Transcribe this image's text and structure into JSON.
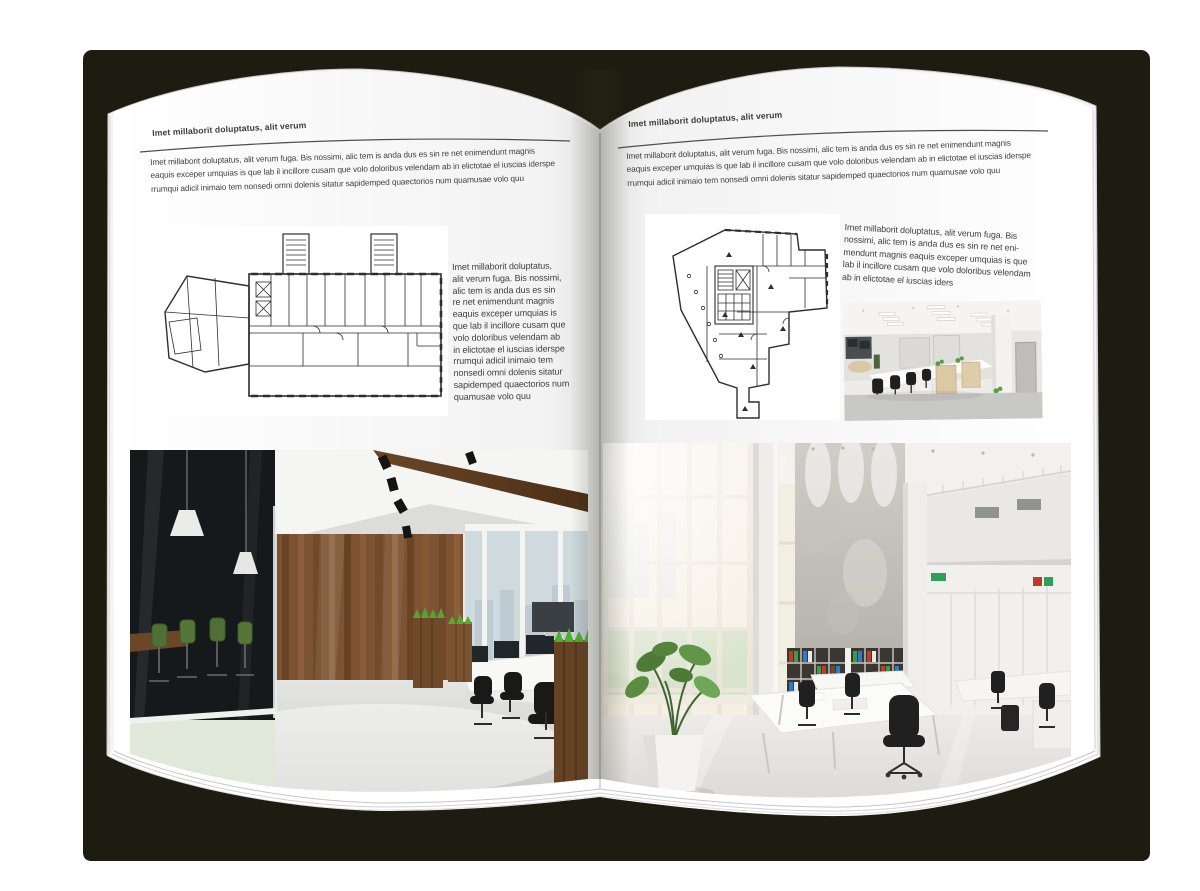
{
  "left_page": {
    "header": "Imet millaborit doluptatus, alit verum",
    "intro_lines": [
      "Imet millaborit doluptatus, alit verum fuga. Bis nossimi, alic tem is anda dus es sin re net enimendunt magnis",
      "eaquis exceper umquias is que lab il incillore cusam que volo doloribus velendam ab in elictotae el iuscias iderspe",
      "rrumqui adicil inimaio tem nonsedi omni dolenis sitatur sapidemped quaectorios num quamusae volo quu"
    ],
    "sidebar_lines": [
      "Imet millaborit doluptatus,",
      "alit verum fuga. Bis nossimi,",
      "alic tem is anda dus es sin",
      "re net enimendunt magnis",
      "eaquis exceper umquias is",
      "que lab il incillore cusam que",
      "volo doloribus velendam ab",
      "in elictotae el iuscias iderspe",
      "rrumqui adicil inimaio tem",
      "nonsedi omni dolenis sitatur",
      "sapidemped quaectorios num",
      "quamusae volo quu"
    ]
  },
  "right_page": {
    "header": "Imet millaborit doluptatus, alit verum",
    "intro_lines": [
      "Imet millaborit doluptatus, alit verum fuga. Bis nossimi, alic tem is anda dus es sin re net enimendunt magnis",
      "eaquis exceper umquias is que lab il incillore cusam que volo doloribus velendam ab in elictotae el iuscias iderspe",
      "rrumqui adicil inimaio tem nonsedi omni dolenis sitatur sapidemped quaectorios num quamusae volo quu"
    ],
    "sidebar_lines": [
      "Imet millaborit doluptatus, alit verum fuga. Bis",
      "nossimi, alic tem is anda dus es sin re net eni-",
      "mendunt magnis eaquis exceper umquias is que",
      "lab il incillore cusam que volo doloribus velendam",
      "ab in elictotae el iuscias iders"
    ]
  },
  "colors": {
    "backdrop": "#ffffff",
    "cover": "#1c1c10",
    "page": "#ffffff",
    "text": "#3d3d3d",
    "rule": "#4f4f4f",
    "plan_line": "#2e2e2e",
    "wood": "#7c5433",
    "chair_green": "#4f6f36",
    "binder_red": "#c13b2c",
    "binder_green": "#3d9c4b",
    "binder_blue": "#2e7cc9"
  }
}
